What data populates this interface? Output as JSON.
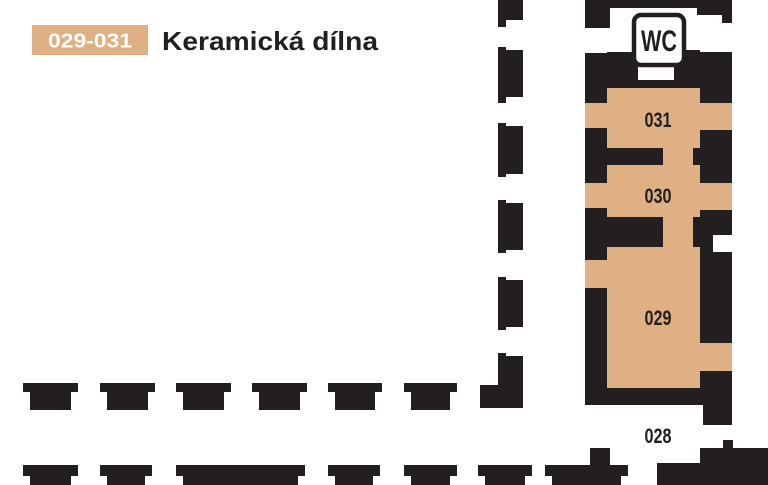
{
  "legend": {
    "range_label": "029-031",
    "title": "Keramická dílna"
  },
  "rooms": [
    {
      "id": "wc",
      "label": "WC",
      "highlighted": false
    },
    {
      "id": "031",
      "label": "031",
      "highlighted": true
    },
    {
      "id": "030",
      "label": "030",
      "highlighted": true
    },
    {
      "id": "029",
      "label": "029",
      "highlighted": true
    },
    {
      "id": "028",
      "label": "028",
      "highlighted": false
    }
  ],
  "colors": {
    "highlight": "#DFB083",
    "wall": "#231F20",
    "background": "#FFFFFF",
    "legend_label_text": "#FFFFFF"
  }
}
